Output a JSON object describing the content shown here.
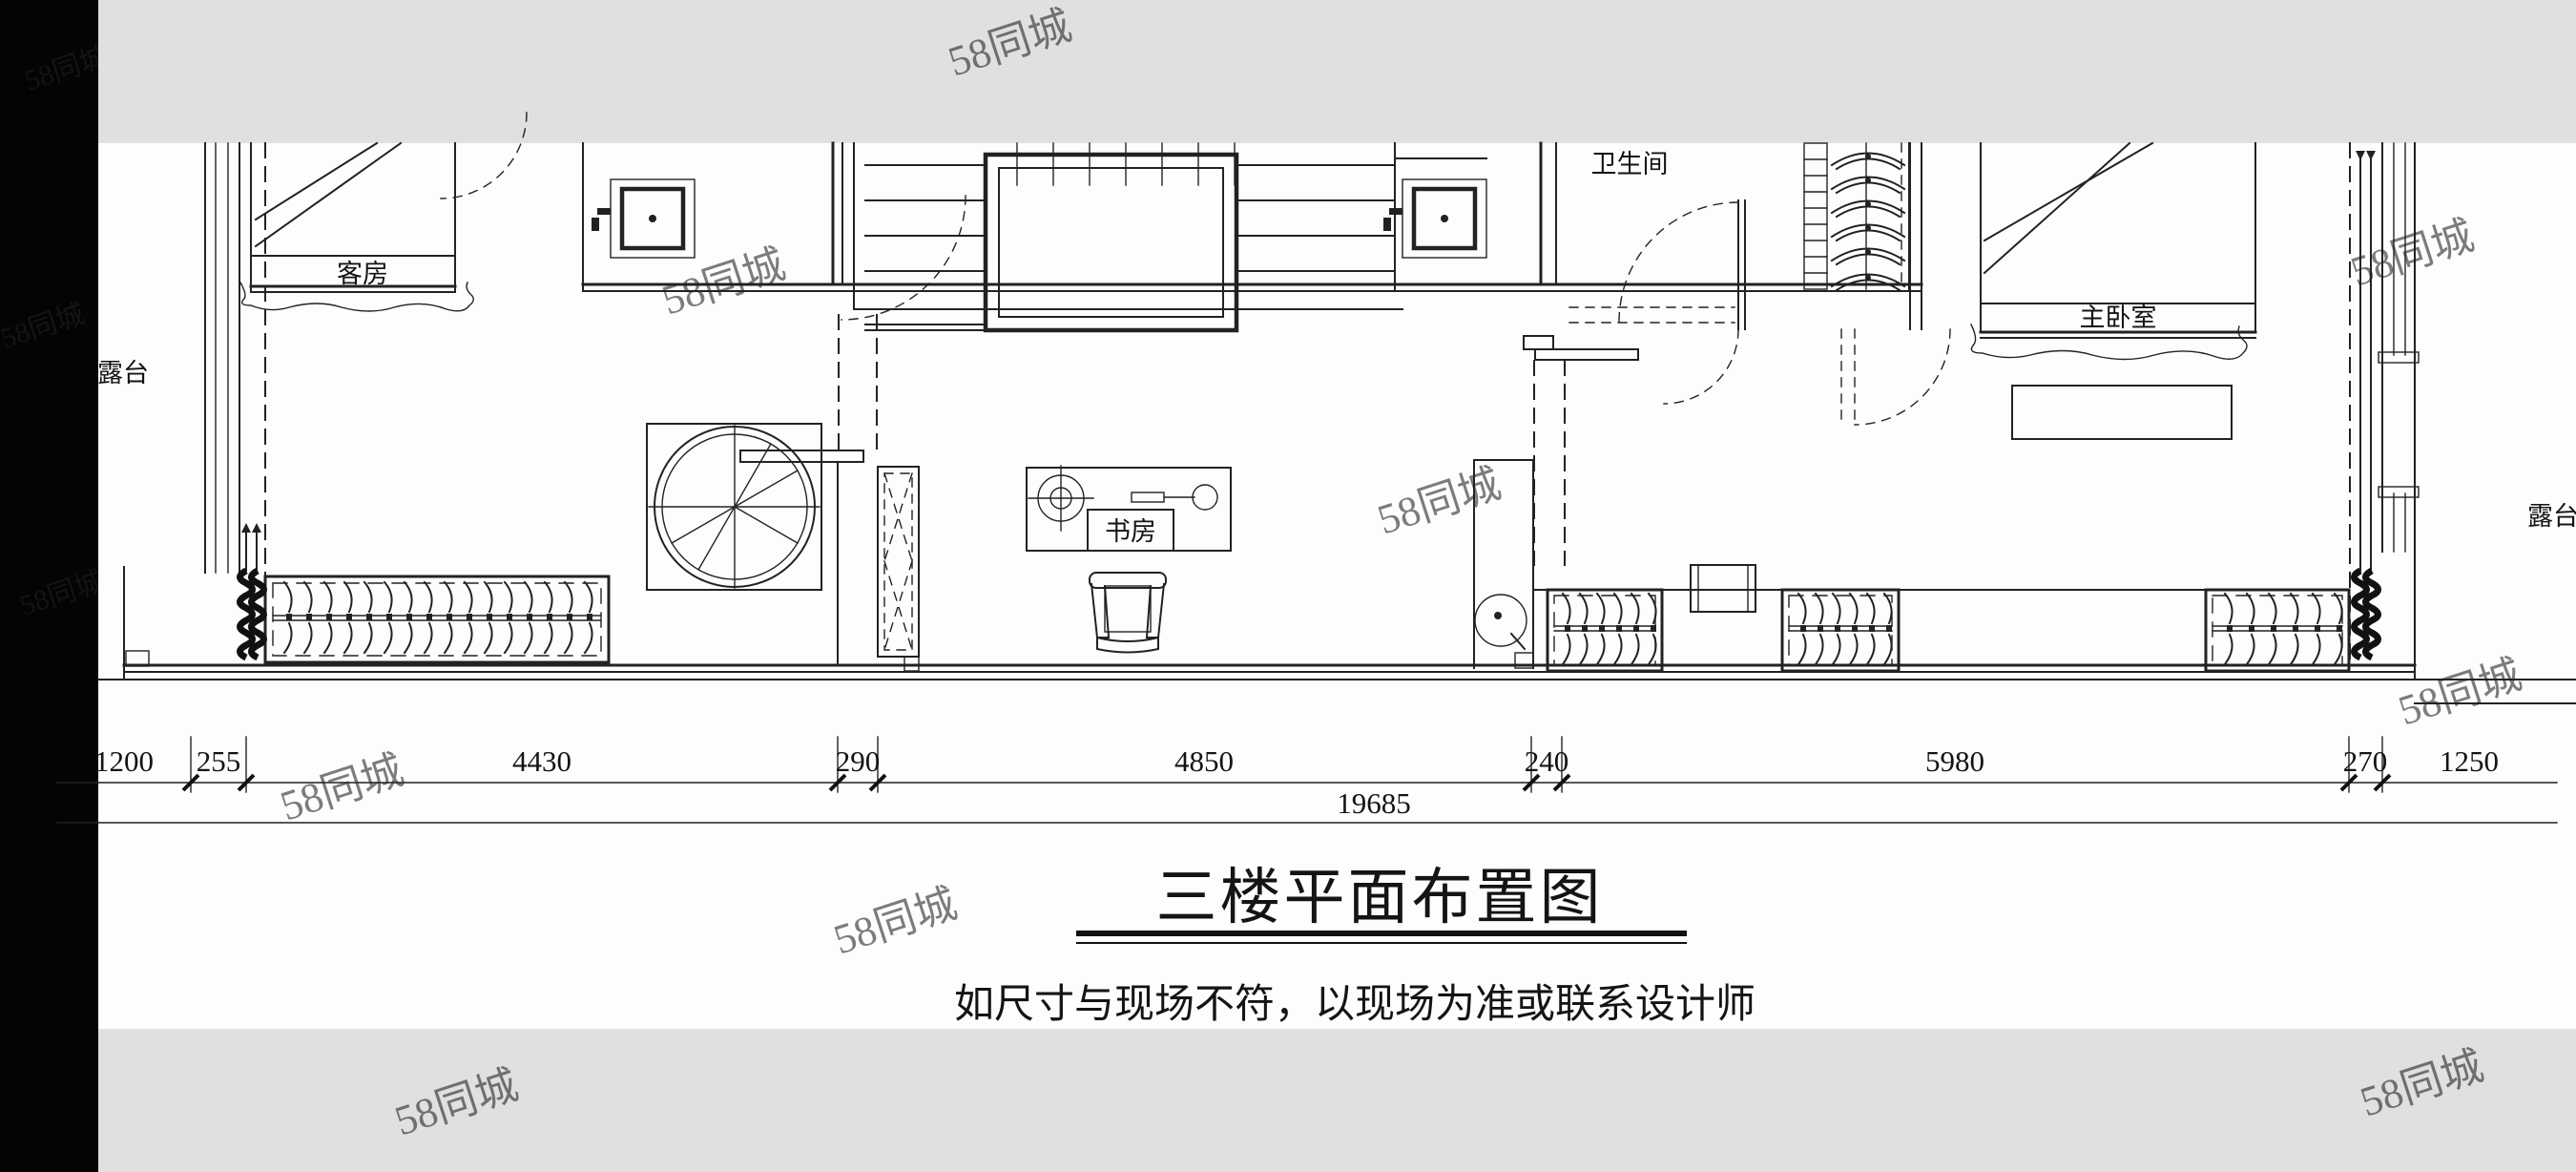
{
  "title_block": {
    "title": "三楼平面布置图",
    "subtitle": "如尺寸与现场不符，以现场为准或联系设计师"
  },
  "rooms": {
    "guest_room": "客房",
    "bathroom": "卫生间",
    "master_bedroom": "主卧室",
    "study": "书房",
    "terrace_left": "露台",
    "terrace_right": "露台"
  },
  "dimensions": {
    "segments": [
      "1200",
      "255",
      "4430",
      "290",
      "4850",
      "240",
      "5980",
      "270",
      "1250"
    ],
    "total": "19685"
  },
  "watermark": {
    "text": "58同城"
  },
  "colors": {
    "ink": "#222222",
    "paper": "#fdfdfd",
    "band": "#e0e0e0",
    "sidebar": "#040404"
  }
}
